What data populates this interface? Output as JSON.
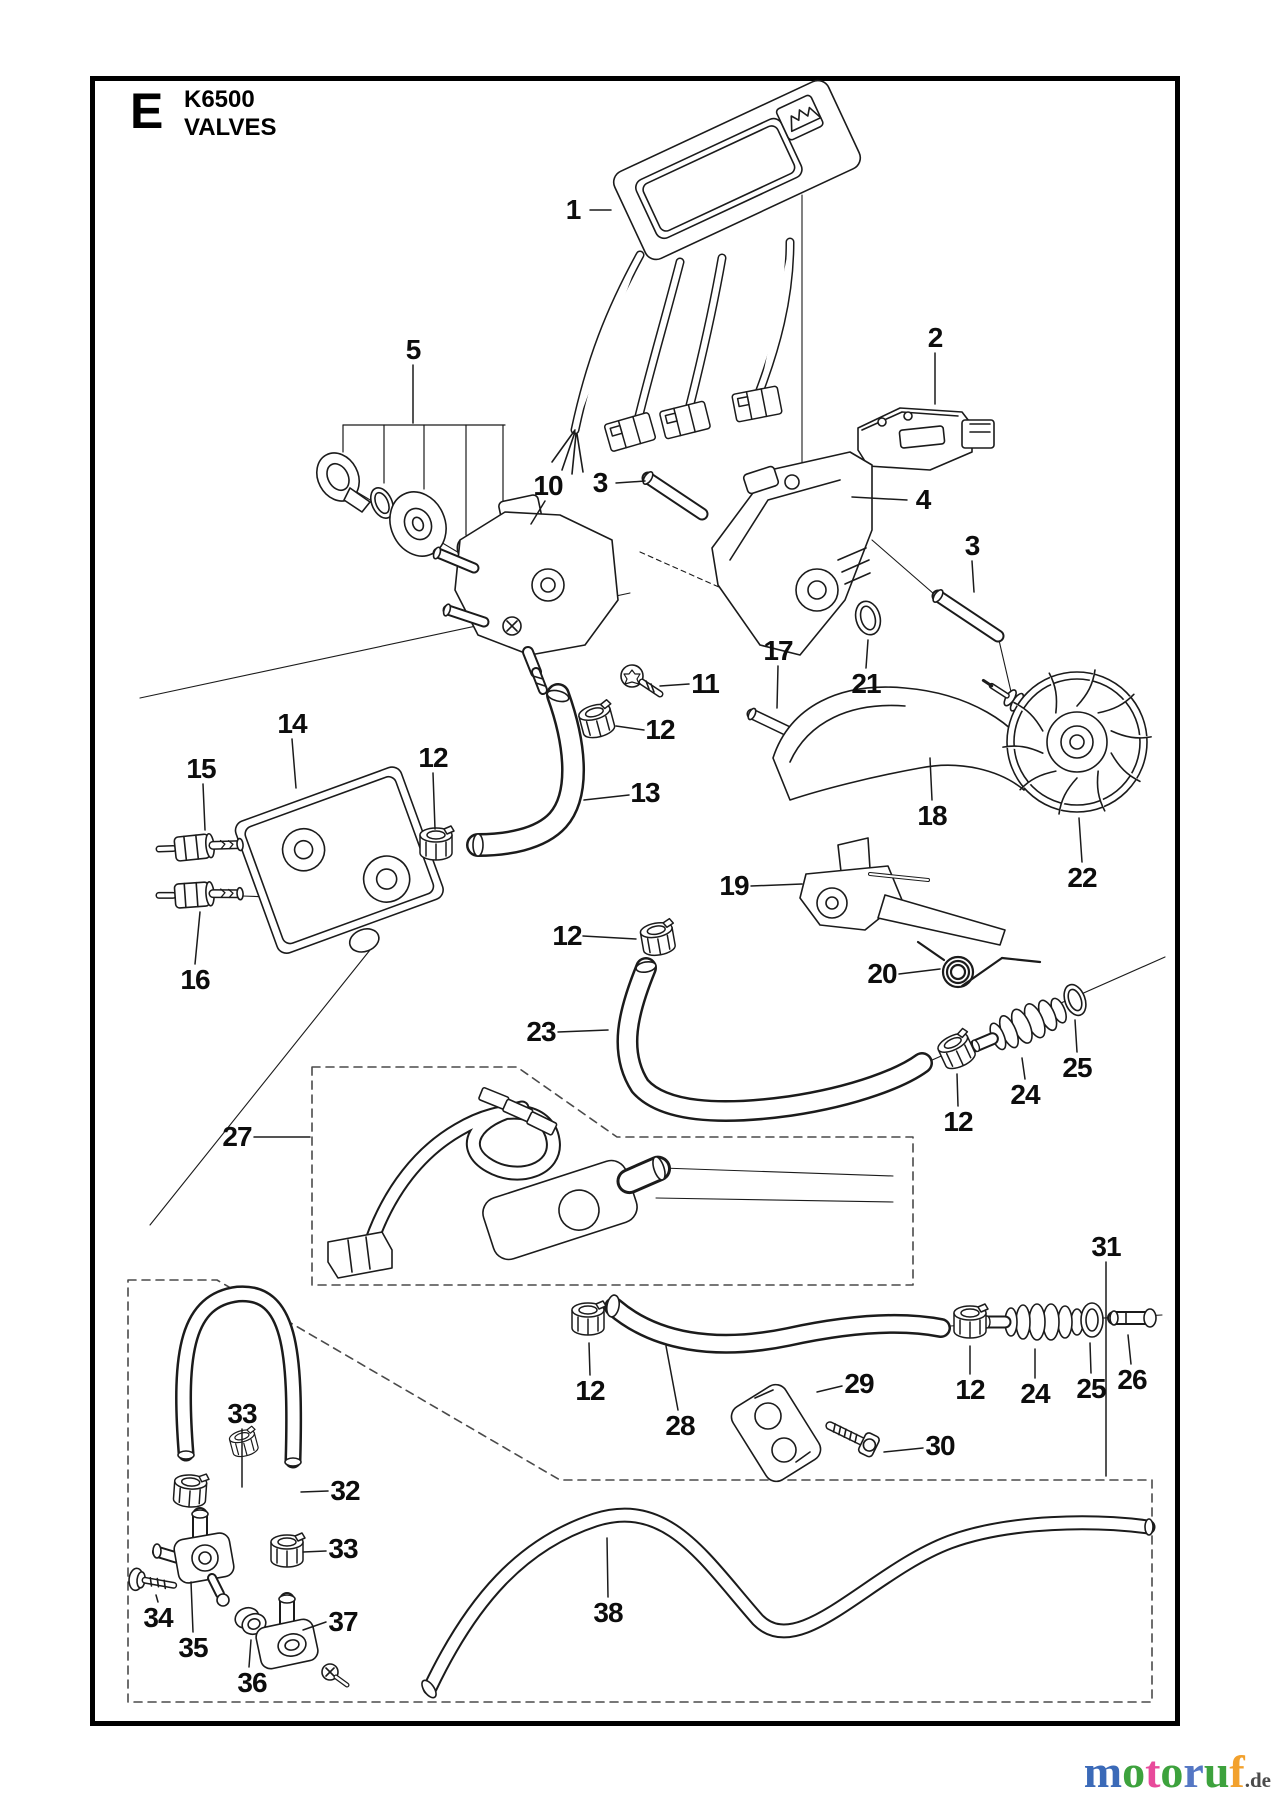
{
  "header": {
    "section_letter": "E",
    "model": "K6500",
    "title": "VALVES"
  },
  "watermark": {
    "letters": [
      {
        "ch": "m",
        "color": "#3b6ab8"
      },
      {
        "ch": "o",
        "color": "#3da23d"
      },
      {
        "ch": "t",
        "color": "#e84a9b"
      },
      {
        "ch": "o",
        "color": "#3da23d"
      },
      {
        "ch": "r",
        "color": "#5577c4"
      },
      {
        "ch": "u",
        "color": "#3da23d"
      },
      {
        "ch": "f",
        "color": "#f2a12d"
      }
    ],
    "suffix": ".de",
    "suffix_color": "#4a4a4a"
  },
  "diagram": {
    "callouts": [
      {
        "n": "1",
        "x": 573,
        "y": 210,
        "leader": [
          590,
          210,
          611,
          210
        ]
      },
      {
        "n": "2",
        "x": 935,
        "y": 338,
        "leader": [
          935,
          353,
          935,
          404
        ]
      },
      {
        "n": "5",
        "x": 413,
        "y": 350,
        "leader": [
          413,
          365,
          413,
          423
        ]
      },
      {
        "n": "10",
        "x": 548,
        "y": 486,
        "leader": [
          545,
          501,
          531,
          524
        ]
      },
      {
        "n": "3",
        "x": 600,
        "y": 483,
        "leader": [
          616,
          483,
          645,
          481
        ]
      },
      {
        "n": "4",
        "x": 923,
        "y": 500,
        "leader": [
          907,
          500,
          852,
          497
        ]
      },
      {
        "n": "3",
        "x": 972,
        "y": 546,
        "leader": [
          972,
          561,
          974,
          592
        ]
      },
      {
        "n": "11",
        "x": 705,
        "y": 684,
        "leader": [
          689,
          684,
          660,
          686
        ]
      },
      {
        "n": "17",
        "x": 778,
        "y": 651,
        "leader": [
          778,
          666,
          777,
          708
        ]
      },
      {
        "n": "21",
        "x": 866,
        "y": 684,
        "leader": [
          866,
          668,
          868,
          640
        ]
      },
      {
        "n": "12",
        "x": 660,
        "y": 730,
        "leader": [
          644,
          730,
          616,
          726
        ]
      },
      {
        "n": "14",
        "x": 292,
        "y": 724,
        "leader": [
          292,
          739,
          296,
          788
        ]
      },
      {
        "n": "15",
        "x": 201,
        "y": 769,
        "leader": [
          203,
          784,
          205,
          830
        ]
      },
      {
        "n": "12",
        "x": 433,
        "y": 758,
        "leader": [
          433,
          773,
          435,
          829
        ]
      },
      {
        "n": "13",
        "x": 645,
        "y": 793,
        "leader": [
          629,
          795,
          584,
          800
        ]
      },
      {
        "n": "18",
        "x": 932,
        "y": 816,
        "leader": [
          932,
          800,
          930,
          758
        ]
      },
      {
        "n": "16",
        "x": 195,
        "y": 980,
        "leader": [
          195,
          964,
          200,
          912
        ]
      },
      {
        "n": "19",
        "x": 734,
        "y": 886,
        "leader": [
          751,
          886,
          802,
          884
        ]
      },
      {
        "n": "22",
        "x": 1082,
        "y": 878,
        "leader": [
          1082,
          862,
          1079,
          818
        ]
      },
      {
        "n": "20",
        "x": 882,
        "y": 974,
        "leader": [
          899,
          974,
          940,
          969
        ]
      },
      {
        "n": "23",
        "x": 541,
        "y": 1032,
        "leader": [
          558,
          1032,
          608,
          1030
        ]
      },
      {
        "n": "12",
        "x": 567,
        "y": 936,
        "leader": [
          583,
          936,
          636,
          939
        ]
      },
      {
        "n": "24",
        "x": 1025,
        "y": 1095,
        "leader": [
          1025,
          1079,
          1022,
          1058
        ]
      },
      {
        "n": "25",
        "x": 1077,
        "y": 1068,
        "leader": [
          1077,
          1052,
          1075,
          1020
        ]
      },
      {
        "n": "12",
        "x": 958,
        "y": 1122,
        "leader": [
          958,
          1106,
          957,
          1074
        ]
      },
      {
        "n": "27",
        "x": 237,
        "y": 1137,
        "leader": [
          254,
          1137,
          310,
          1137
        ]
      },
      {
        "n": "28",
        "x": 680,
        "y": 1426,
        "leader": [
          678,
          1410,
          666,
          1346
        ]
      },
      {
        "n": "29",
        "x": 859,
        "y": 1384,
        "leader": [
          842,
          1386,
          817,
          1392
        ]
      },
      {
        "n": "30",
        "x": 940,
        "y": 1446,
        "leader": [
          923,
          1448,
          884,
          1452
        ]
      },
      {
        "n": "12",
        "x": 590,
        "y": 1391,
        "leader": [
          590,
          1375,
          589,
          1343
        ]
      },
      {
        "n": "12",
        "x": 970,
        "y": 1390,
        "leader": [
          970,
          1374,
          970,
          1346
        ]
      },
      {
        "n": "24",
        "x": 1035,
        "y": 1394,
        "leader": [
          1035,
          1378,
          1035,
          1349
        ]
      },
      {
        "n": "25",
        "x": 1091,
        "y": 1389,
        "leader": [
          1091,
          1373,
          1090,
          1343
        ]
      },
      {
        "n": "26",
        "x": 1132,
        "y": 1380,
        "leader": [
          1131,
          1364,
          1128,
          1335
        ]
      },
      {
        "n": "31",
        "x": 1106,
        "y": 1247,
        "leader": [
          1106,
          1262,
          1106,
          1476
        ]
      },
      {
        "n": "33",
        "x": 242,
        "y": 1414,
        "leader": [
          242,
          1429,
          242,
          1487
        ]
      },
      {
        "n": "32",
        "x": 345,
        "y": 1491,
        "leader": [
          328,
          1491,
          301,
          1492
        ]
      },
      {
        "n": "33",
        "x": 343,
        "y": 1549,
        "leader": [
          326,
          1551,
          303,
          1552
        ]
      },
      {
        "n": "34",
        "x": 158,
        "y": 1618,
        "leader": [
          158,
          1602,
          156,
          1595
        ]
      },
      {
        "n": "35",
        "x": 193,
        "y": 1648,
        "leader": [
          193,
          1632,
          191,
          1582
        ]
      },
      {
        "n": "36",
        "x": 252,
        "y": 1683,
        "leader": [
          249,
          1667,
          251,
          1640
        ]
      },
      {
        "n": "37",
        "x": 343,
        "y": 1622,
        "leader": [
          326,
          1622,
          303,
          1630
        ]
      },
      {
        "n": "38",
        "x": 608,
        "y": 1613,
        "leader": [
          608,
          1597,
          607,
          1538
        ]
      }
    ]
  }
}
